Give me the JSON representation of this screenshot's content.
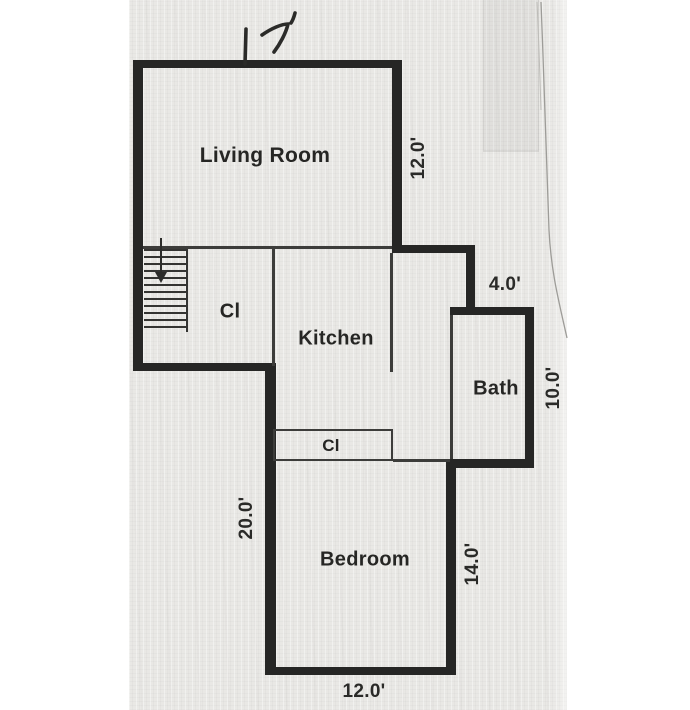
{
  "title": "scanned floor plan",
  "annotation": {
    "handwritten_width": "17'"
  },
  "rooms": {
    "living": {
      "label": "Living Room"
    },
    "kitchen": {
      "label": "Kitchen"
    },
    "bath": {
      "label": "Bath"
    },
    "bedroom": {
      "label": "Bedroom"
    },
    "closet_hall": {
      "label": "Cl"
    },
    "closet_bedroom": {
      "label": "Cl"
    }
  },
  "dimensions": {
    "living_right": "12.0'",
    "bath_top": "4.0'",
    "bath_right": "10.0'",
    "bedroom_left": "20.0'",
    "bedroom_right": "14.0'",
    "bedroom_bottom": "12.0'"
  },
  "icons": {
    "stairs": "stairs-down-arrow"
  },
  "colors": {
    "wall": "#262625",
    "interior_line": "#3c3c3a",
    "paper": "#e9e8e5",
    "margin": "#ffffff",
    "text": "#262624"
  }
}
